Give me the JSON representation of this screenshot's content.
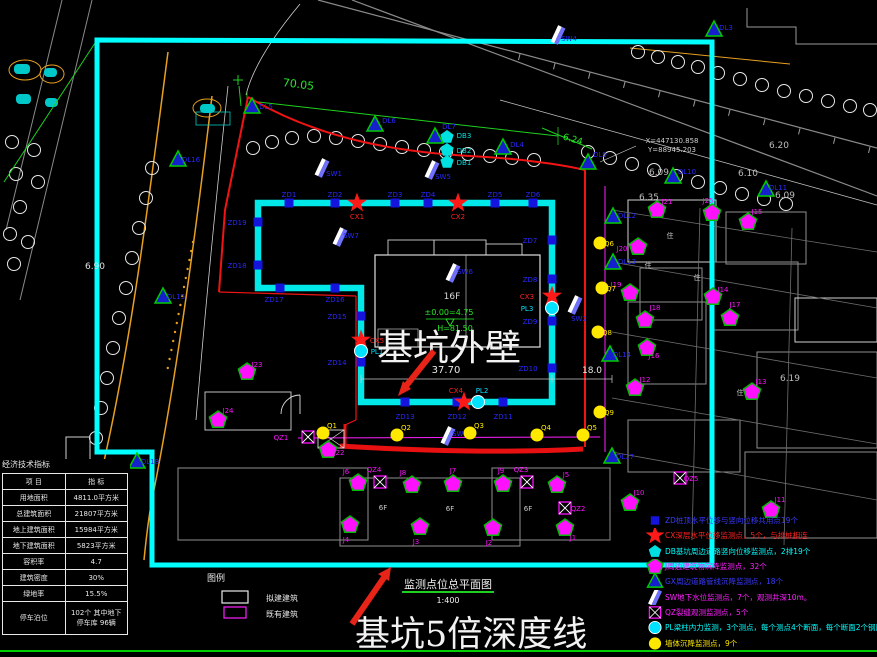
{
  "colors": {
    "cyan": "#00ffff",
    "red": "#f01414",
    "green": "#27e827",
    "magenta": "#ff20ff",
    "yellow": "#ffe800",
    "blue": "#1414dd",
    "orange": "#e8a020"
  },
  "annotations": {
    "pit_wall": "基坑外壁",
    "depth_line": "基坑5倍深度线"
  },
  "title_block": {
    "drawing_title": "监测点位总平面图",
    "scale": "1:400",
    "legend_label": "图例",
    "legend_boxes": [
      {
        "label": "拟建建筑"
      },
      {
        "label": "既有建筑"
      }
    ]
  },
  "stats_table": {
    "title": "经济技术指标",
    "headers": [
      "项  目",
      "指  标"
    ],
    "rows": [
      [
        "用地面积",
        "4811.0平方米"
      ],
      [
        "总建筑面积",
        "21807平方米"
      ],
      [
        "地上建筑面积",
        "15984平方米"
      ],
      [
        "地下建筑面积",
        "5823平方米"
      ],
      [
        "容积率",
        "4.7"
      ],
      [
        "建筑密度",
        "30%"
      ],
      [
        "绿地率",
        "15.5%"
      ],
      [
        "停车泊位",
        "102个 其中地下停车库 96辆"
      ]
    ]
  },
  "legend": {
    "items": [
      {
        "sym": "zd",
        "color": "#3a3aff",
        "text": "ZD桩顶水平位移与竖向位移共用点19个"
      },
      {
        "sym": "cx",
        "color": "#ff2222",
        "text": "CX深层水平位移监测点，5个，与排桩相连"
      },
      {
        "sym": "db",
        "color": "#00ffff",
        "text": "DB基坑周边道路竖向位移监测点，2排19个"
      },
      {
        "sym": "j",
        "color": "#ff20ff",
        "text": "J周边建筑物沉降监测点，32个"
      },
      {
        "sym": "dl",
        "color": "#3a3aff",
        "text": "GX周边道路管线沉降监测点，18个"
      },
      {
        "sym": "sw",
        "color": "#ff20ff",
        "text": "SW地下水位监测点，7个，观测井深10m。"
      },
      {
        "sym": "qz",
        "color": "#ff20ff",
        "text": "QZ裂缝观测监测点，5个"
      },
      {
        "sym": "pl",
        "color": "#00ffff",
        "text": "PL梁柱内力监测，3个测点，每个测点4个断面，每个断面2个钢筋计"
      },
      {
        "sym": "q",
        "color": "#ffe800",
        "text": "墙体沉降监测点，9个"
      }
    ]
  },
  "markers": {
    "zd": [
      {
        "x": 289,
        "y": 203,
        "label": "ZD1",
        "dx": 0,
        "dy": -6
      },
      {
        "x": 335,
        "y": 203,
        "label": "ZD2",
        "dx": 0,
        "dy": -6
      },
      {
        "x": 395,
        "y": 203,
        "label": "ZD3",
        "dx": 0,
        "dy": -6
      },
      {
        "x": 428,
        "y": 203,
        "label": "ZD4",
        "dx": 0,
        "dy": -6
      },
      {
        "x": 495,
        "y": 203,
        "label": "ZD5",
        "dx": 0,
        "dy": -6
      },
      {
        "x": 533,
        "y": 203,
        "label": "ZD6",
        "dx": 0,
        "dy": -6
      },
      {
        "x": 552,
        "y": 240,
        "label": "ZD7",
        "dx": -22,
        "dy": 3
      },
      {
        "x": 552,
        "y": 279,
        "label": "ZD8",
        "dx": -22,
        "dy": 3
      },
      {
        "x": 552,
        "y": 321,
        "label": "ZD9",
        "dx": -22,
        "dy": 3
      },
      {
        "x": 552,
        "y": 368,
        "label": "ZD10",
        "dx": -24,
        "dy": 3
      },
      {
        "x": 503,
        "y": 402,
        "label": "ZD11",
        "dx": 0,
        "dy": 17
      },
      {
        "x": 457,
        "y": 402,
        "label": "ZD12",
        "dx": 0,
        "dy": 17
      },
      {
        "x": 405,
        "y": 402,
        "label": "ZD13",
        "dx": 0,
        "dy": 17
      },
      {
        "x": 361,
        "y": 362,
        "label": "ZD14",
        "dx": -24,
        "dy": 3
      },
      {
        "x": 361,
        "y": 316,
        "label": "ZD15",
        "dx": -24,
        "dy": 3
      },
      {
        "x": 335,
        "y": 288,
        "label": "ZD16",
        "dx": 0,
        "dy": 14
      },
      {
        "x": 280,
        "y": 288,
        "label": "ZD17",
        "dx": -6,
        "dy": 14
      },
      {
        "x": 258,
        "y": 265,
        "label": "ZD18",
        "dx": -21,
        "dy": 3
      },
      {
        "x": 258,
        "y": 222,
        "label": "ZD19",
        "dx": -21,
        "dy": 3
      }
    ],
    "cx": [
      {
        "x": 357,
        "y": 203,
        "label": "CX1",
        "dx": 0,
        "dy": 16
      },
      {
        "x": 458,
        "y": 203,
        "label": "CX2",
        "dx": 0,
        "dy": 16
      },
      {
        "x": 552,
        "y": 296,
        "label": "CX3",
        "dx": -25,
        "dy": 3
      },
      {
        "x": 464,
        "y": 402,
        "label": "CX4",
        "dx": -8,
        "dy": -9
      },
      {
        "x": 361,
        "y": 340,
        "label": "CX5",
        "dx": 16,
        "dy": 3
      }
    ],
    "pl": [
      {
        "x": 361,
        "y": 351,
        "label": "PL1",
        "dx": 16,
        "dy": 3
      },
      {
        "x": 478,
        "y": 402,
        "label": "PL2",
        "dx": 4,
        "dy": -9
      },
      {
        "x": 552,
        "y": 308,
        "label": "PL3",
        "dx": -25,
        "dy": 3
      }
    ],
    "db": [
      {
        "x": 447,
        "y": 137,
        "label": "DB3",
        "dx": 17,
        "dy": 1
      },
      {
        "x": 447,
        "y": 150,
        "label": "DB2",
        "dx": 17,
        "dy": 3
      },
      {
        "x": 447,
        "y": 162,
        "label": "DB1",
        "dx": 17,
        "dy": 3
      }
    ],
    "sw": [
      {
        "x": 322,
        "y": 168,
        "label": "SW1",
        "dx": 12,
        "dy": 8
      },
      {
        "x": 432,
        "y": 170,
        "label": "SW5",
        "dx": 11,
        "dy": 9
      },
      {
        "x": 340,
        "y": 237,
        "label": "SW7",
        "dx": 11,
        "dy": 1
      },
      {
        "x": 453,
        "y": 273,
        "label": "SW6",
        "dx": 12,
        "dy": 1
      },
      {
        "x": 575,
        "y": 305,
        "label": "SW2",
        "dx": 4,
        "dy": 16
      },
      {
        "x": 448,
        "y": 436,
        "label": "SW3",
        "dx": 12,
        "dy": 0
      },
      {
        "x": 558,
        "y": 35,
        "label": "SW4",
        "dx": 11,
        "dy": 6
      }
    ],
    "dl": [
      {
        "x": 252,
        "y": 107,
        "label": "DL5",
        "dx": 14,
        "dy": 2
      },
      {
        "x": 375,
        "y": 125,
        "label": "DL6",
        "dx": 14,
        "dy": -2
      },
      {
        "x": 435,
        "y": 137,
        "label": "DL7",
        "dx": 14,
        "dy": -8
      },
      {
        "x": 503,
        "y": 148,
        "label": "DL4",
        "dx": 14,
        "dy": -1
      },
      {
        "x": 588,
        "y": 163,
        "label": "DL9",
        "dx": 12,
        "dy": -6
      },
      {
        "x": 673,
        "y": 177,
        "label": "DL10",
        "dx": 14,
        "dy": -3
      },
      {
        "x": 766,
        "y": 190,
        "label": "DL11",
        "dx": 12,
        "dy": 0
      },
      {
        "x": 714,
        "y": 30,
        "label": "DL3",
        "dx": 12,
        "dy": 0
      },
      {
        "x": 613,
        "y": 217,
        "label": "DL12",
        "dx": 14,
        "dy": 1
      },
      {
        "x": 613,
        "y": 263,
        "label": "DL13",
        "dx": 14,
        "dy": 1
      },
      {
        "x": 610,
        "y": 355,
        "label": "DL14",
        "dx": 12,
        "dy": 2
      },
      {
        "x": 163,
        "y": 297,
        "label": "DL15",
        "dx": 13,
        "dy": 2
      },
      {
        "x": 178,
        "y": 160,
        "label": "DL16",
        "dx": 13,
        "dy": 2
      },
      {
        "x": 612,
        "y": 457,
        "label": "DL17",
        "dx": 13,
        "dy": 2
      },
      {
        "x": 137,
        "y": 462,
        "label": "DL18",
        "dx": 13,
        "dy": 2
      }
    ],
    "j": [
      {
        "x": 350,
        "y": 525,
        "label": "J4",
        "dx": -4,
        "dy": 17
      },
      {
        "x": 420,
        "y": 527,
        "label": "J3",
        "dx": -4,
        "dy": 17
      },
      {
        "x": 493,
        "y": 528,
        "label": "J2",
        "dx": -4,
        "dy": 17
      },
      {
        "x": 565,
        "y": 528,
        "label": "J1",
        "dx": 8,
        "dy": 12
      },
      {
        "x": 358,
        "y": 483,
        "label": "J6",
        "dx": -12,
        "dy": -9
      },
      {
        "x": 412,
        "y": 485,
        "label": "J8",
        "dx": -9,
        "dy": -10
      },
      {
        "x": 453,
        "y": 484,
        "label": "J7",
        "dx": 0,
        "dy": -11
      },
      {
        "x": 503,
        "y": 484,
        "label": "J9",
        "dx": -2,
        "dy": -11
      },
      {
        "x": 557,
        "y": 485,
        "label": "J5",
        "dx": 9,
        "dy": -8
      },
      {
        "x": 328,
        "y": 450,
        "label": "J22",
        "dx": 11,
        "dy": 5
      },
      {
        "x": 218,
        "y": 420,
        "label": "J24",
        "dx": 10,
        "dy": -7
      },
      {
        "x": 247,
        "y": 372,
        "label": "J23",
        "dx": 10,
        "dy": -5
      },
      {
        "x": 630,
        "y": 503,
        "label": "J10",
        "dx": 9,
        "dy": -8
      },
      {
        "x": 771,
        "y": 510,
        "label": "J11",
        "dx": 9,
        "dy": -8
      },
      {
        "x": 635,
        "y": 388,
        "label": "J12",
        "dx": 10,
        "dy": -6
      },
      {
        "x": 752,
        "y": 392,
        "label": "J13",
        "dx": 9,
        "dy": -8
      },
      {
        "x": 713,
        "y": 297,
        "label": "J14",
        "dx": 10,
        "dy": -5
      },
      {
        "x": 748,
        "y": 222,
        "label": "J15",
        "dx": 9,
        "dy": -8
      },
      {
        "x": 657,
        "y": 210,
        "label": "J21",
        "dx": 10,
        "dy": -6
      },
      {
        "x": 712,
        "y": 213,
        "label": "J25",
        "dx": -4,
        "dy": -10
      },
      {
        "x": 638,
        "y": 247,
        "label": "J20",
        "dx": -16,
        "dy": 4
      },
      {
        "x": 630,
        "y": 293,
        "label": "J19",
        "dx": -14,
        "dy": -6
      },
      {
        "x": 645,
        "y": 320,
        "label": "J18",
        "dx": 10,
        "dy": -10
      },
      {
        "x": 647,
        "y": 348,
        "label": "J16",
        "dx": 7,
        "dy": 10
      },
      {
        "x": 730,
        "y": 318,
        "label": "J17",
        "dx": 5,
        "dy": -11
      }
    ],
    "q": [
      {
        "x": 323,
        "y": 433,
        "label": "Q1",
        "dx": 9,
        "dy": -5
      },
      {
        "x": 397,
        "y": 435,
        "label": "Q2",
        "dx": 9,
        "dy": -5
      },
      {
        "x": 470,
        "y": 433,
        "label": "Q3",
        "dx": 9,
        "dy": -5
      },
      {
        "x": 537,
        "y": 435,
        "label": "Q4",
        "dx": 9,
        "dy": -5
      },
      {
        "x": 583,
        "y": 435,
        "label": "Q5",
        "dx": 9,
        "dy": -5
      },
      {
        "x": 600,
        "y": 243,
        "label": "Q6",
        "dx": 9,
        "dy": 3
      },
      {
        "x": 602,
        "y": 288,
        "label": "Q7",
        "dx": 9,
        "dy": 3
      },
      {
        "x": 598,
        "y": 332,
        "label": "Q8",
        "dx": 9,
        "dy": 3
      },
      {
        "x": 600,
        "y": 412,
        "label": "Q9",
        "dx": 9,
        "dy": 3
      }
    ],
    "qz": [
      {
        "x": 308,
        "y": 437,
        "label": "QZ1",
        "dx": -27,
        "dy": 3
      },
      {
        "x": 380,
        "y": 482,
        "label": "QZ4",
        "dx": -6,
        "dy": -10
      },
      {
        "x": 527,
        "y": 482,
        "label": "QZ3",
        "dx": -6,
        "dy": -10
      },
      {
        "x": 565,
        "y": 508,
        "label": "QZ2",
        "dx": 13,
        "dy": 3
      },
      {
        "x": 680,
        "y": 478,
        "label": "QZ5",
        "dx": 11,
        "dy": 3
      }
    ]
  },
  "texts": [
    {
      "x": 298,
      "y": 88,
      "t": "70.05",
      "c": "#27e827",
      "s": 11,
      "r": 7
    },
    {
      "x": 572,
      "y": 142,
      "t": "6.24",
      "c": "#27e827",
      "s": 9,
      "r": 16
    },
    {
      "x": 95,
      "y": 269,
      "t": "6.90",
      "c": "#e0e0e0",
      "s": 9
    },
    {
      "x": 779,
      "y": 148,
      "t": "6.20",
      "c": "#bdbdbd",
      "s": 9
    },
    {
      "x": 748,
      "y": 176,
      "t": "6.10",
      "c": "#bdbdbd",
      "s": 9
    },
    {
      "x": 659,
      "y": 175,
      "t": "6.09",
      "c": "#bdbdbd",
      "s": 9
    },
    {
      "x": 785,
      "y": 198,
      "t": "6.09",
      "c": "#bdbdbd",
      "s": 9
    },
    {
      "x": 649,
      "y": 200,
      "t": "6.35",
      "c": "#bdbdbd",
      "s": 9
    },
    {
      "x": 790,
      "y": 381,
      "t": "6.19",
      "c": "#bdbdbd",
      "s": 9
    },
    {
      "x": 446,
      "y": 373,
      "t": "37.70",
      "c": "#e8e8e8",
      "s": 10
    },
    {
      "x": 592,
      "y": 373,
      "t": "18.0",
      "c": "#e8e8e8",
      "s": 9
    },
    {
      "x": 452,
      "y": 299,
      "t": "16F",
      "c": "#d8d8d8",
      "s": 9
    },
    {
      "x": 449,
      "y": 315,
      "t": "±0.00=4.75",
      "c": "#27e827",
      "s": 8
    },
    {
      "x": 455,
      "y": 331,
      "t": "H=81.50",
      "c": "#27e827",
      "s": 8
    },
    {
      "x": 672,
      "y": 143,
      "t": "X=447130.858",
      "c": "#cfcfcf",
      "s": 7
    },
    {
      "x": 672,
      "y": 152,
      "t": "Y=88945.203",
      "c": "#cfcfcf",
      "s": 7
    },
    {
      "x": 216,
      "y": 581,
      "t": "图例",
      "c": "#e8e8e8",
      "s": 9
    },
    {
      "x": 282,
      "y": 601,
      "t": "拟建建筑",
      "c": "#e8e8e8",
      "s": 8
    },
    {
      "x": 282,
      "y": 617,
      "t": "既有建筑",
      "c": "#e8e8e8",
      "s": 8
    },
    {
      "x": 670,
      "y": 238,
      "t": "住",
      "c": "#cccccc",
      "s": 7
    },
    {
      "x": 648,
      "y": 268,
      "t": "住",
      "c": "#cccccc",
      "s": 7
    },
    {
      "x": 697,
      "y": 280,
      "t": "住",
      "c": "#cccccc",
      "s": 7
    },
    {
      "x": 740,
      "y": 395,
      "t": "住",
      "c": "#cccccc",
      "s": 7
    },
    {
      "x": 383,
      "y": 510,
      "t": "6F",
      "c": "#cccccc",
      "s": 7
    },
    {
      "x": 450,
      "y": 511,
      "t": "6F",
      "c": "#cccccc",
      "s": 7
    },
    {
      "x": 528,
      "y": 511,
      "t": "6F",
      "c": "#cccccc",
      "s": 7
    }
  ]
}
